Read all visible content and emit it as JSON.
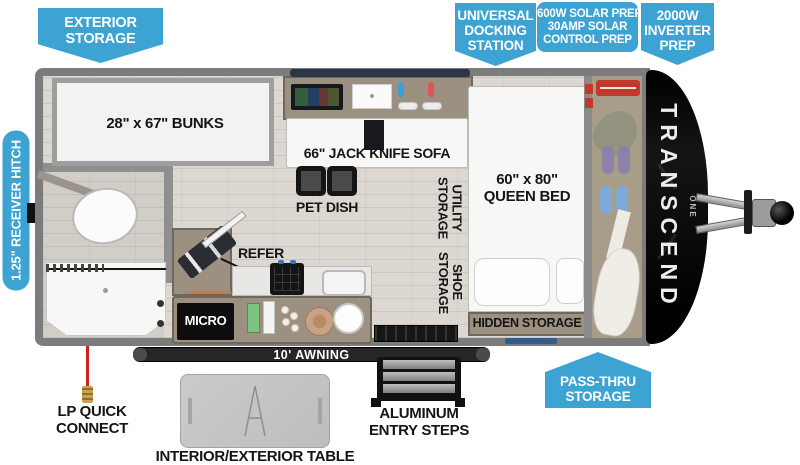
{
  "colors": {
    "accent": "#3da3d3",
    "wall_gray": "#7c7c7c",
    "front_cap_black": "#0b0b0b",
    "awning_black": "#262626",
    "lp_line_red": "#cc2127",
    "cabinet_tan": "#9c9180"
  },
  "callouts": {
    "exterior_storage": {
      "line1": "EXTERIOR",
      "line2": "STORAGE"
    },
    "universal_docking_station": {
      "line1": "UNIVERSAL",
      "line2": "DOCKING",
      "line3": "STATION"
    },
    "solar_prep": {
      "line1": "600W SOLAR PREP",
      "line2": "30AMP SOLAR",
      "line3": "CONTROL PREP"
    },
    "inverter_prep": {
      "line1": "2000W",
      "line2": "INVERTER",
      "line3": "PREP"
    },
    "receiver_hitch": {
      "label": "1.25\" RECEIVER HITCH"
    },
    "pass_thru_storage": {
      "line1": "PASS-THRU",
      "line2": "STORAGE"
    }
  },
  "interior_labels": {
    "bunks": "28\" x 67\" BUNKS",
    "jack_knife_sofa": "66\" JACK KNIFE SOFA",
    "pet_dish": "PET DISH",
    "refer": "REFER",
    "micro": "MICRO",
    "utility_storage_line1": "UTILITY",
    "utility_storage_line2": "STORAGE",
    "shoe_storage_line1": "SHOE",
    "shoe_storage_line2": "STORAGE",
    "queen_bed_line1": "60\" x 80\"",
    "queen_bed_line2": "QUEEN BED",
    "hidden_storage": "HIDDEN STORAGE",
    "awning": "10' AWNING"
  },
  "exterior_labels": {
    "lp_quick_connect_line1": "LP QUICK",
    "lp_quick_connect_line2": "CONNECT",
    "table": "INTERIOR/EXTERIOR TABLE",
    "entry_steps_line1": "ALUMINUM",
    "entry_steps_line2": "ENTRY STEPS"
  },
  "branding": {
    "model": "TRANSCEND",
    "series": "ONE"
  }
}
